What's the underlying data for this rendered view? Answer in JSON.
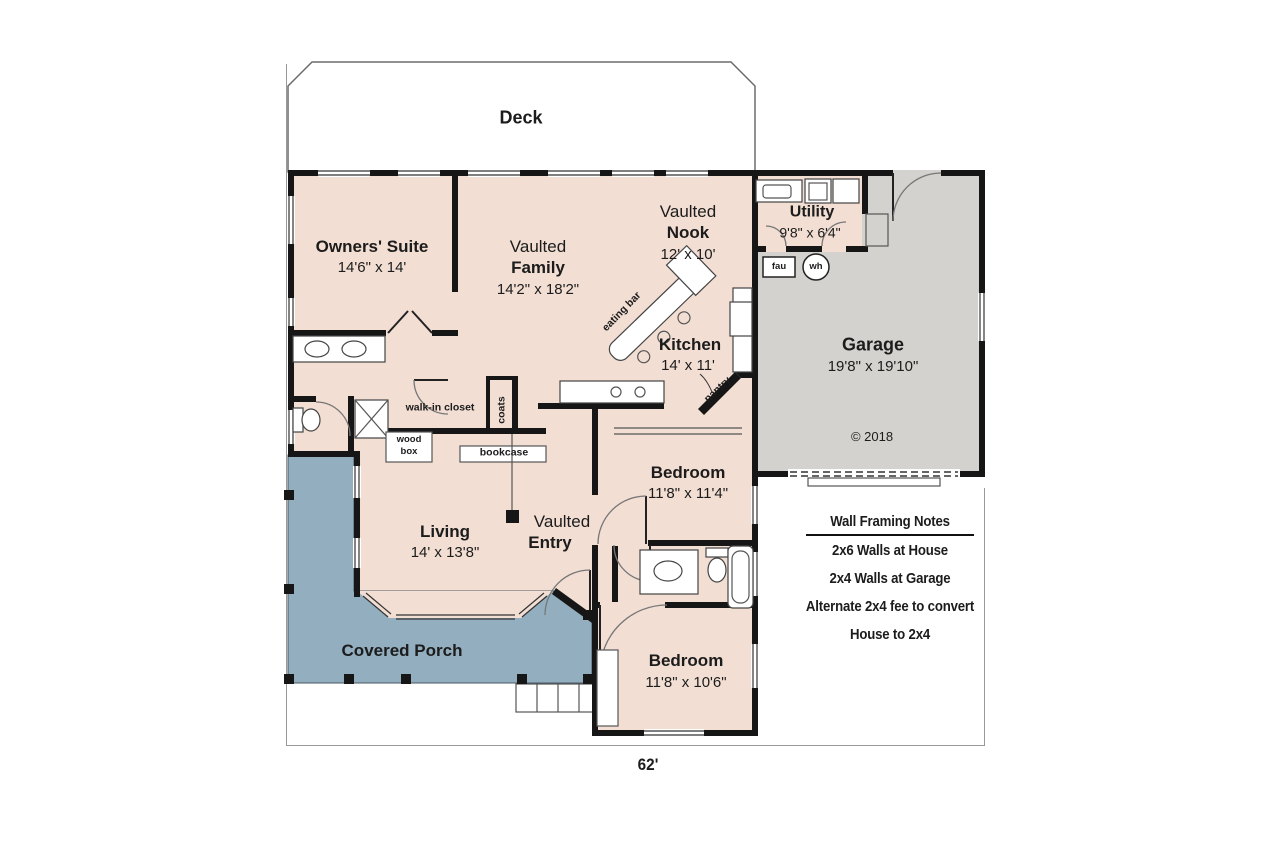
{
  "colors": {
    "interior": "#f2ded3",
    "garage": "#d4d2ce",
    "porch": "#92aebf",
    "wall": "#161616"
  },
  "rooms": {
    "deck": {
      "name": "Deck"
    },
    "owners_suite": {
      "name": "Owners' Suite",
      "dims": "14'6\" x 14'"
    },
    "family": {
      "line1": "Vaulted",
      "line2": "Family",
      "dims": "14'2\" x 18'2\""
    },
    "nook": {
      "line1": "Vaulted",
      "line2": "Nook",
      "dims": "12' x 10'"
    },
    "utility": {
      "name": "Utility",
      "dims": "9'8\" x 6'4\""
    },
    "kitchen": {
      "name": "Kitchen",
      "dims": "14' x 11'"
    },
    "garage": {
      "name": "Garage",
      "dims": "19'8\" x 19'10\"",
      "copyright": "© 2018"
    },
    "bedroom1": {
      "name": "Bedroom",
      "dims": "11'8\" x 11'4\""
    },
    "living": {
      "name": "Living",
      "dims": "14' x 13'8\""
    },
    "entry": {
      "line1": "Vaulted",
      "line2": "Entry"
    },
    "porch": {
      "name": "Covered Porch"
    },
    "bedroom2": {
      "name": "Bedroom",
      "dims": "11'8\" x 10'6\""
    }
  },
  "annotations": {
    "walk_in_closet": "walk-in closet",
    "coats": "coats",
    "wood_box_line1": "wood",
    "wood_box_line2": "box",
    "bookcase": "bookcase",
    "eating_bar": "eating bar",
    "pantry": "pantry",
    "fau": "fau",
    "wh": "wh"
  },
  "notes": {
    "title": "Wall Framing Notes",
    "lines": [
      "2x6 Walls at House",
      "2x4 Walls at Garage",
      "Alternate 2x4 fee to convert",
      "House to 2x4"
    ]
  },
  "dimensions": {
    "overall_width": "62'"
  }
}
